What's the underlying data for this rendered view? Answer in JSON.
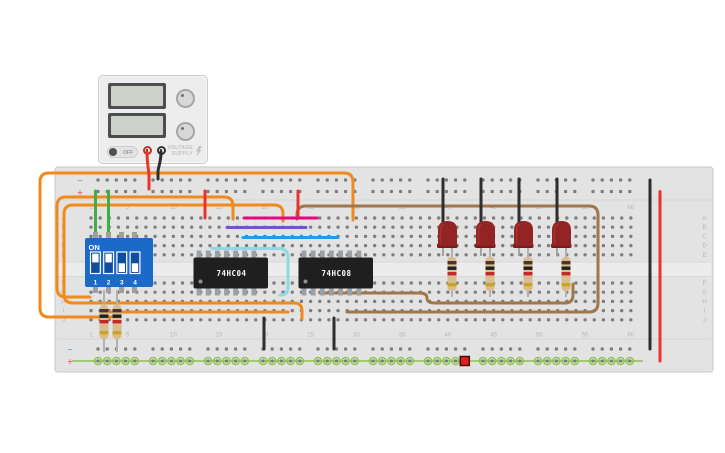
{
  "power_supply": {
    "off_label": "OFF",
    "brand_line1": "VOLTAGE",
    "brand_line2": "SUPPLY",
    "positive_terminal_color": "#c33028",
    "negative_terminal_color": "#333333"
  },
  "dip_switch": {
    "on_label": "ON",
    "body_color": "#1b69c8",
    "slot_color": "#0f4e9e",
    "switches": [
      {
        "label": "1",
        "state": "on"
      },
      {
        "label": "2",
        "state": "on"
      },
      {
        "label": "3",
        "state": "off"
      },
      {
        "label": "4",
        "state": "off"
      }
    ]
  },
  "ics": [
    {
      "label": "74HC04"
    },
    {
      "label": "74HC08"
    }
  ],
  "breadboard": {
    "row_letters": [
      "A",
      "B",
      "C",
      "D",
      "E",
      "F",
      "G",
      "H",
      "I",
      "J"
    ],
    "column_labels": [
      "1",
      "5",
      "10",
      "15",
      "20",
      "25",
      "30",
      "35",
      "40",
      "45",
      "50",
      "55",
      "60"
    ],
    "minus_sign": "−",
    "plus_sign": "+",
    "board_color": "#e3e3e3",
    "channel_color": "#ececec",
    "hole_color": "#7d7d7d",
    "label_color": "#b5b5b5",
    "minus_mark_color": "#7bafd4",
    "plus_mark_color": "#e57373",
    "highlight_net_color": "#8bc34a",
    "selected_hole_color": "#e11e1e"
  },
  "leds": {
    "count": 4,
    "body_color": "#932424",
    "base_color": "#771b1b",
    "lead_color": "#9e9e9e"
  },
  "resistors": {
    "body_color": "#d9bc8f",
    "band_colors": [
      "#4e342e",
      "#212121",
      "#c62828",
      "#c9a227"
    ],
    "lead_color": "#b0b0b0"
  },
  "wire_colors": {
    "orange": "#f18a1d",
    "red": "#e8352c",
    "black": "#2e2e2e",
    "green": "#3fae49",
    "brown": "#a1764b",
    "pink": "#e5097f",
    "purple": "#7356bf",
    "blue": "#1e9be9",
    "cyan": "#8fd8e8"
  }
}
